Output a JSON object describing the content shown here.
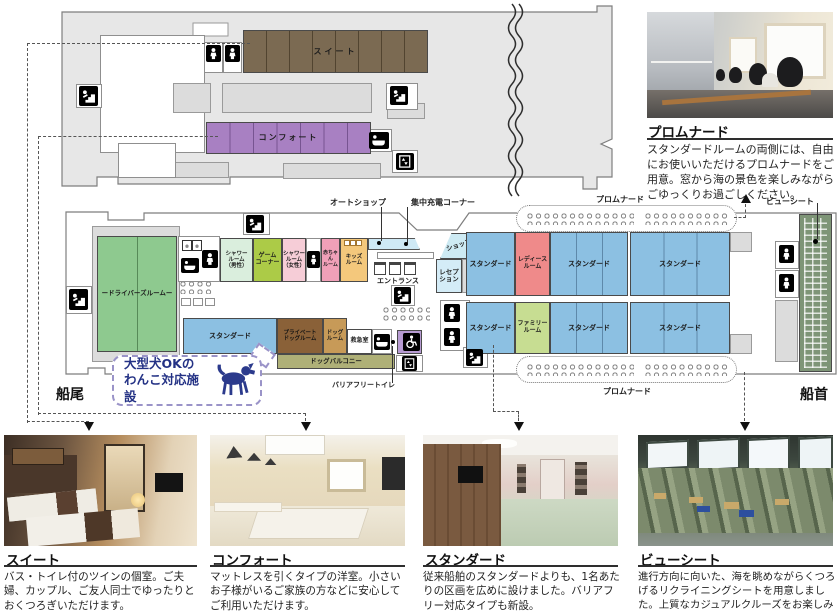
{
  "colors": {
    "hull": "#e7e7e7",
    "suite": "#7b6a52",
    "comfort": "#a880c2",
    "standard": "#8cc0e2",
    "ladies": "#ef8a8a",
    "family": "#c7dd92",
    "drivers": "#8ec98f",
    "shower_m": "#daeedd",
    "game": "#accb47",
    "shower_f": "#f6cdd7",
    "baby": "#f0a0b8",
    "kids": "#f4c87c",
    "private_dog": "#8a6138",
    "dog_room": "#c79a58",
    "dog_balcony": "#afb077",
    "first_aid": "#ffffff",
    "barrier_free": "#b79bd2",
    "view_seat": "#7e9577",
    "shop": "#cdeaf3",
    "reception": "#d4ecf7",
    "auto_strip": "#cfe9f5"
  },
  "deck": {
    "upper": {
      "suite": "スイート",
      "comfort": "コンフォート"
    },
    "lower": {
      "drivers": "ードライバーズルームー",
      "shower_m": "シャワー\nルーム\n（男性）",
      "game": "ゲーム\nコーナー",
      "shower_f": "シャワー\nルーム\n（女性）",
      "baby": "赤ちゃん\nルーム",
      "kids": "キッズ\nルーム",
      "shop": "ショップ",
      "reception": "レセプ\nション",
      "standard": "スタンダード",
      "ladies": "レディース\nルーム",
      "family": "ファミリー\nルーム",
      "private_dog": "プライベート\nドッグルーム",
      "dog_room": "ドッグ\nルーム",
      "first_aid": "救急室",
      "dog_balcony": "ドッグバルコニー"
    },
    "callouts": {
      "auto_shop": "オートショップ",
      "charging": "集中充電コーナー",
      "entrance": "エントランス",
      "promenade": "プロムナード",
      "view_seat": "ビューシート",
      "barrier_free": "バリアフリートイレ",
      "stern": "船尾",
      "bow": "船首"
    },
    "bubble": {
      "line1": "大型犬OKの",
      "line2": "わんこ対応施設"
    }
  },
  "sections": {
    "promenade": {
      "title": "プロムナード",
      "description": "スタンダードルームの両側には、自由にお使いいただけるプロムナードをご用意。窓から海の景色を楽しみながらごゆっくりお過ごしください。"
    },
    "suite": {
      "title": "スイート",
      "description": "バス・トイレ付のツインの個室。ご夫婦、カップル、ご友人同士でゆったりとおくつろぎいただけます。"
    },
    "comfort": {
      "title": "コンフォート",
      "description": "マットレスを引くタイプの洋室。小さいお子様がいるご家族の方などに安心してご利用いただけます。"
    },
    "standard": {
      "title": "スタンダード",
      "description": "従来船舶のスタンダードよりも、1名あたりの区画を広めに設けました。バリアフリー対応タイプも新設。"
    },
    "view_seat": {
      "title": "ビューシート",
      "description": "進行方向に向いた、海を眺めながらくつろげるリクライニングシートを用意しました。上質なカジュアルクルーズをお楽しみください。"
    }
  },
  "icons": {
    "stairs": "stairs-icon",
    "mens_toilet": "mens-toilet-icon",
    "womens_toilet": "womens-toilet-icon",
    "bath": "bath-icon",
    "elevator": "elevator-icon",
    "wheelchair": "wheelchair-icon",
    "washer": "washing-machine-icon",
    "dog": "dog-silhouette-icon",
    "chairs": "chairs-cluster-icon"
  }
}
